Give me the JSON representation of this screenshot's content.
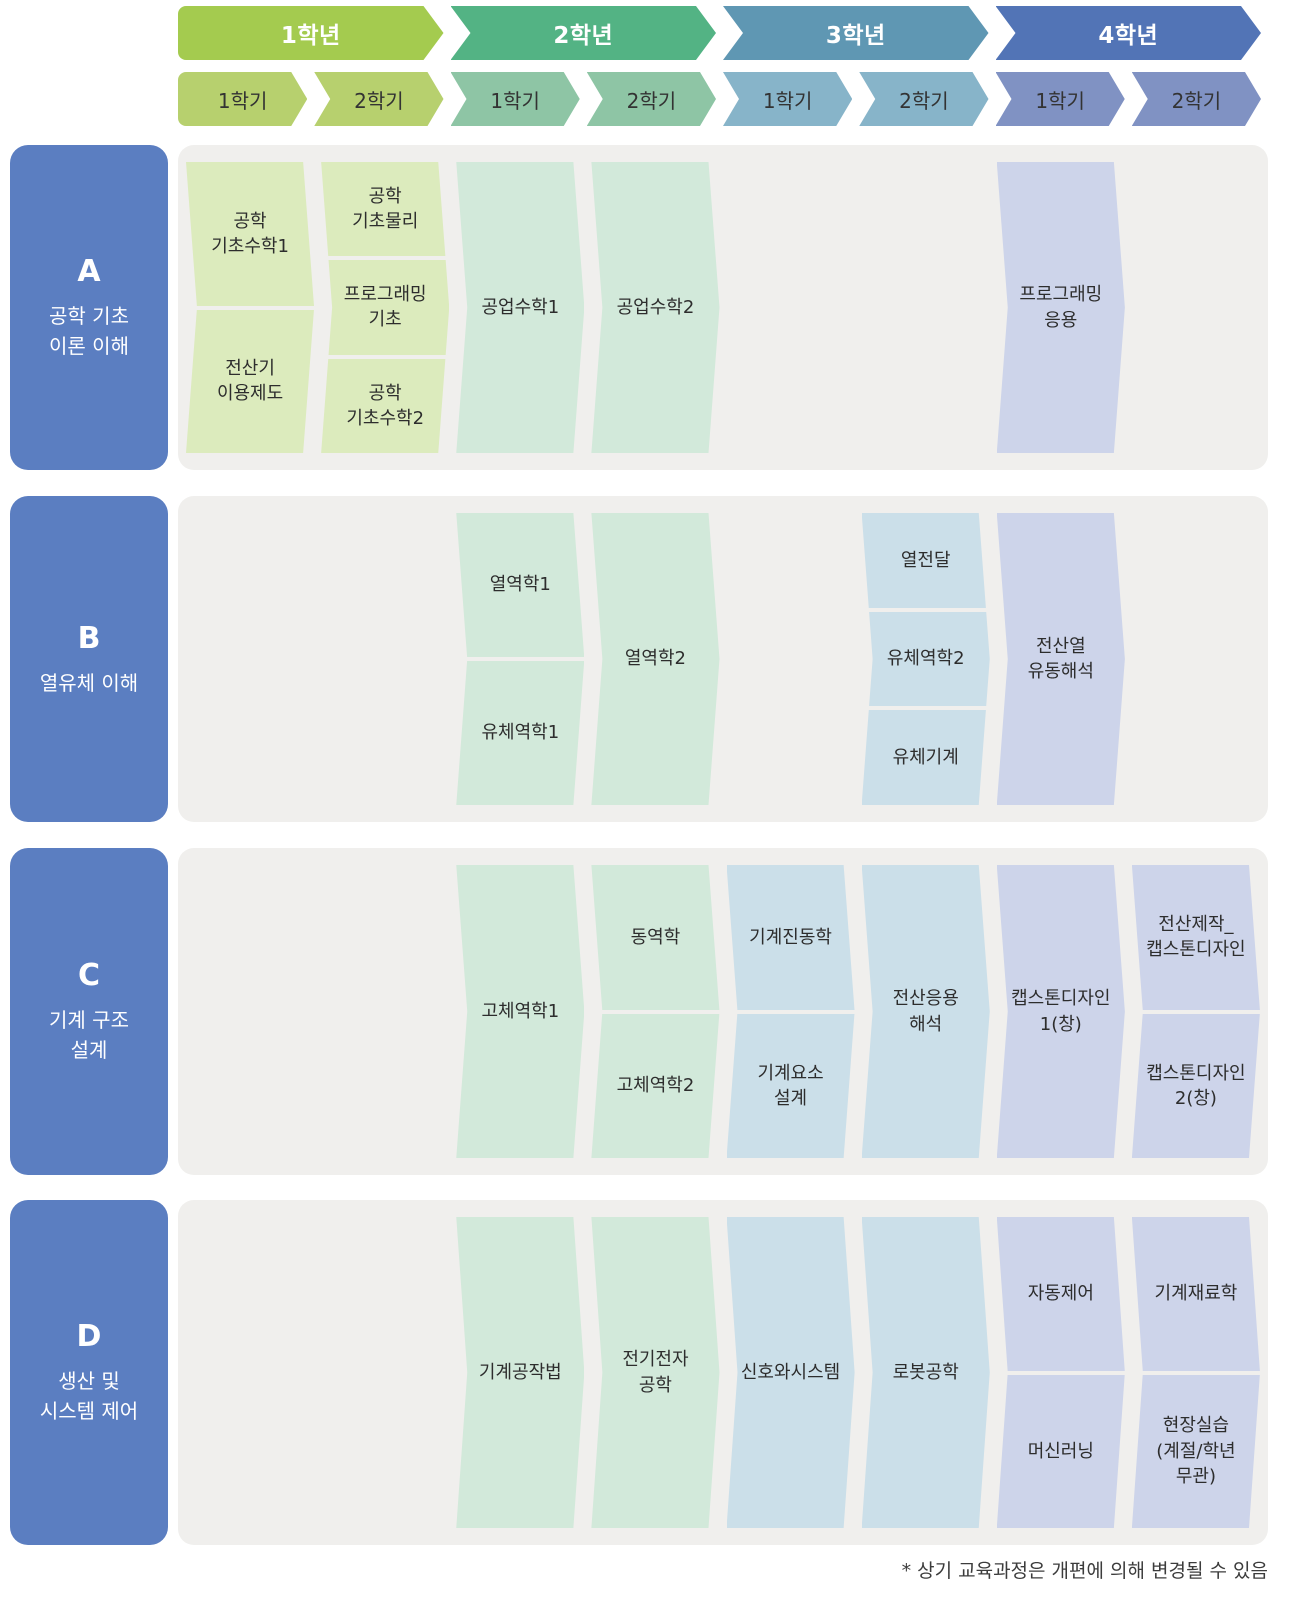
{
  "colors": {
    "row_label_bg": "#5b7ec1",
    "panel_bg": "#f0efed",
    "year_text": "#ffffff",
    "sem_text": "#333333",
    "course_text": "#2d2d2d",
    "footnote_text": "#3c3c3c"
  },
  "years": [
    {
      "label": "1학년",
      "header_color": "#a4cb4f",
      "sem_color": "#b7d06e",
      "course_color": "#dcebbd",
      "semesters": [
        "1학기",
        "2학기"
      ]
    },
    {
      "label": "2학년",
      "header_color": "#53b384",
      "sem_color": "#8ec5a5",
      "course_color": "#d2e9da",
      "semesters": [
        "1학기",
        "2학기"
      ]
    },
    {
      "label": "3학년",
      "header_color": "#5f97b3",
      "sem_color": "#87b4c9",
      "course_color": "#cbdfe9",
      "semesters": [
        "1학기",
        "2학기"
      ]
    },
    {
      "label": "4학년",
      "header_color": "#5274b6",
      "sem_color": "#8092c3",
      "course_color": "#cdd4ea",
      "semesters": [
        "1학기",
        "2학기"
      ]
    }
  ],
  "rows": [
    {
      "letter": "A",
      "title": "공학 기초\n이론 이해",
      "cells": [
        {
          "col": 0,
          "year": 0,
          "courses": [
            "공학\n기초수학1",
            "전산기\n이용제도"
          ]
        },
        {
          "col": 1,
          "year": 0,
          "courses": [
            "공학\n기초물리",
            "프로그래밍\n기초",
            "공학\n기초수학2"
          ]
        },
        {
          "col": 2,
          "year": 1,
          "courses": [
            "공업수학1"
          ]
        },
        {
          "col": 3,
          "year": 1,
          "courses": [
            "공업수학2"
          ]
        },
        {
          "col": 6,
          "year": 3,
          "courses": [
            "프로그래밍\n응용"
          ]
        }
      ]
    },
    {
      "letter": "B",
      "title": "열유체 이해",
      "cells": [
        {
          "col": 2,
          "year": 1,
          "courses": [
            "열역학1",
            "유체역학1"
          ]
        },
        {
          "col": 3,
          "year": 1,
          "courses": [
            "열역학2"
          ]
        },
        {
          "col": 5,
          "year": 2,
          "courses": [
            "열전달",
            "유체역학2",
            "유체기계"
          ]
        },
        {
          "col": 6,
          "year": 3,
          "courses": [
            "전산열\n유동해석"
          ]
        }
      ]
    },
    {
      "letter": "C",
      "title": "기계 구조\n설계",
      "cells": [
        {
          "col": 2,
          "year": 1,
          "courses": [
            "고체역학1"
          ]
        },
        {
          "col": 3,
          "year": 1,
          "courses": [
            "동역학",
            "고체역학2"
          ]
        },
        {
          "col": 4,
          "year": 2,
          "courses": [
            "기계진동학",
            "기계요소\n설계"
          ]
        },
        {
          "col": 5,
          "year": 2,
          "courses": [
            "전산응용\n해석"
          ]
        },
        {
          "col": 6,
          "year": 3,
          "courses": [
            "캡스톤디자인\n1(창)"
          ]
        },
        {
          "col": 7,
          "year": 3,
          "courses": [
            "전산제작_\n캡스톤디자인",
            "캡스톤디자인\n2(창)"
          ]
        }
      ]
    },
    {
      "letter": "D",
      "title": "생산 및\n시스템 제어",
      "cells": [
        {
          "col": 2,
          "year": 1,
          "courses": [
            "기계공작법"
          ]
        },
        {
          "col": 3,
          "year": 1,
          "courses": [
            "전기전자\n공학"
          ]
        },
        {
          "col": 4,
          "year": 2,
          "courses": [
            "신호와시스템"
          ]
        },
        {
          "col": 5,
          "year": 2,
          "courses": [
            "로봇공학"
          ]
        },
        {
          "col": 6,
          "year": 3,
          "courses": [
            "자동제어",
            "머신러닝"
          ]
        },
        {
          "col": 7,
          "year": 3,
          "courses": [
            "기계재료학",
            "현장실습\n(계절/학년\n무관)"
          ]
        }
      ]
    }
  ],
  "footnote": "* 상기 교육과정은 개편에 의해 변경될 수 있음"
}
